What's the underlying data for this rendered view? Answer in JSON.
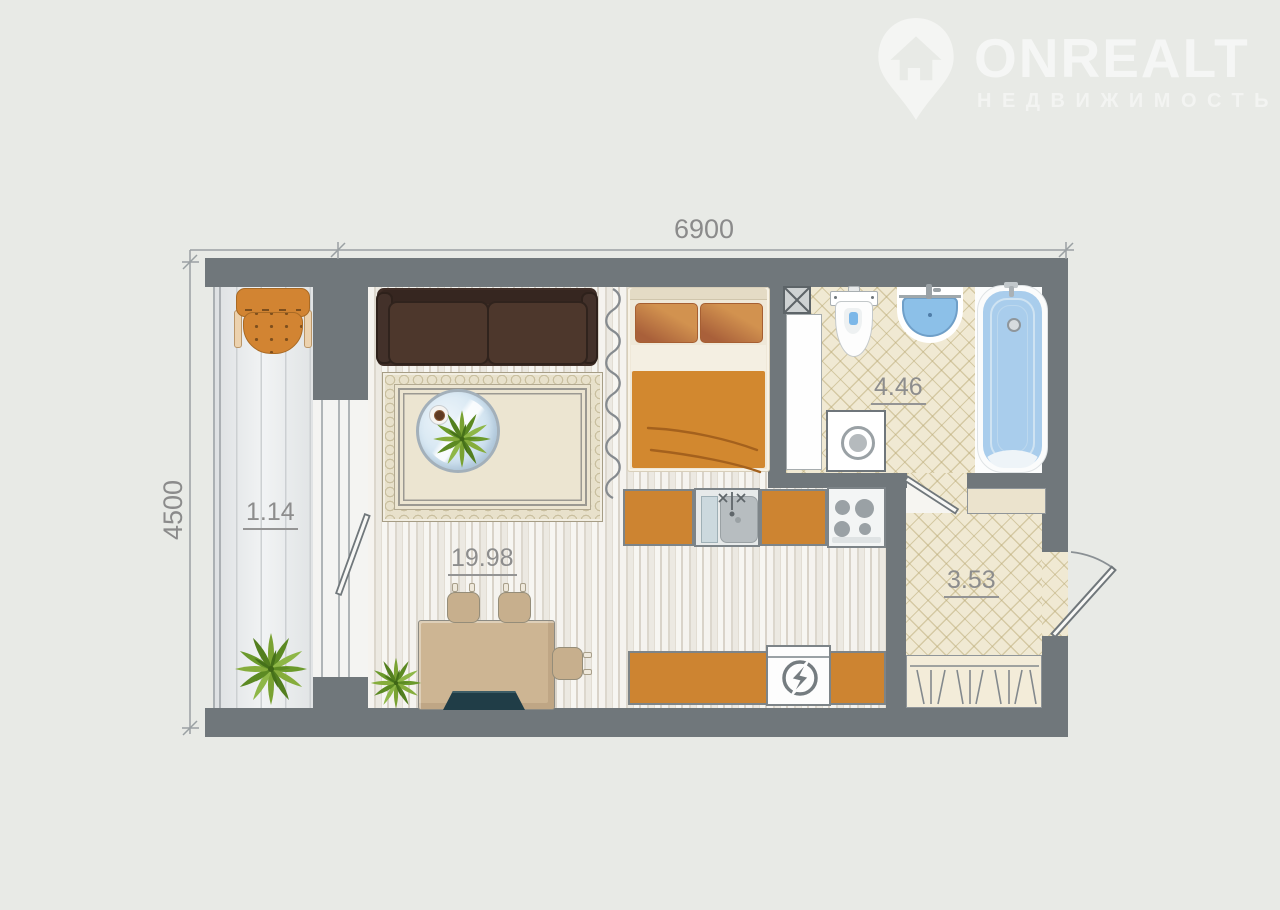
{
  "logo": {
    "brand": "ONREALT",
    "tagline": "НЕДВИЖИМОСТЬ",
    "icon": "map-pin-house-icon"
  },
  "dimensions": {
    "width": "6900",
    "height": "4500",
    "unit": "mm"
  },
  "rooms": [
    {
      "name": "balcony",
      "area": "1.14"
    },
    {
      "name": "living-kitchen",
      "area": "19.98"
    },
    {
      "name": "bathroom",
      "area": "4.46"
    },
    {
      "name": "hallway",
      "area": "3.53"
    }
  ],
  "fixtures": [
    "armchair-icon",
    "sofa-icon",
    "rug-icon",
    "coffee-table-icon",
    "coffee-cup-icon",
    "plant-icon",
    "double-bed-icon",
    "curtain-divider-icon",
    "kitchen-cabinet-icon",
    "kitchen-sink-icon",
    "stove-icon",
    "refrigerator-icon",
    "dining-table-icon",
    "chair-icon",
    "laptop-icon",
    "toilet-icon",
    "washbasin-icon",
    "bathtub-icon",
    "washing-machine-icon",
    "ventilation-shaft-icon",
    "tall-cabinet-icon",
    "shelf-icon",
    "wardrobe-icon",
    "door-icon",
    "window-icon"
  ],
  "colors": {
    "background": "#e8eae6",
    "wall": "#70777b",
    "accent_orange": "#cd8431",
    "water_blue": "#8cc0e8",
    "tile_beige": "#f0e9d3",
    "dimension_text": "#8b8b8b"
  }
}
